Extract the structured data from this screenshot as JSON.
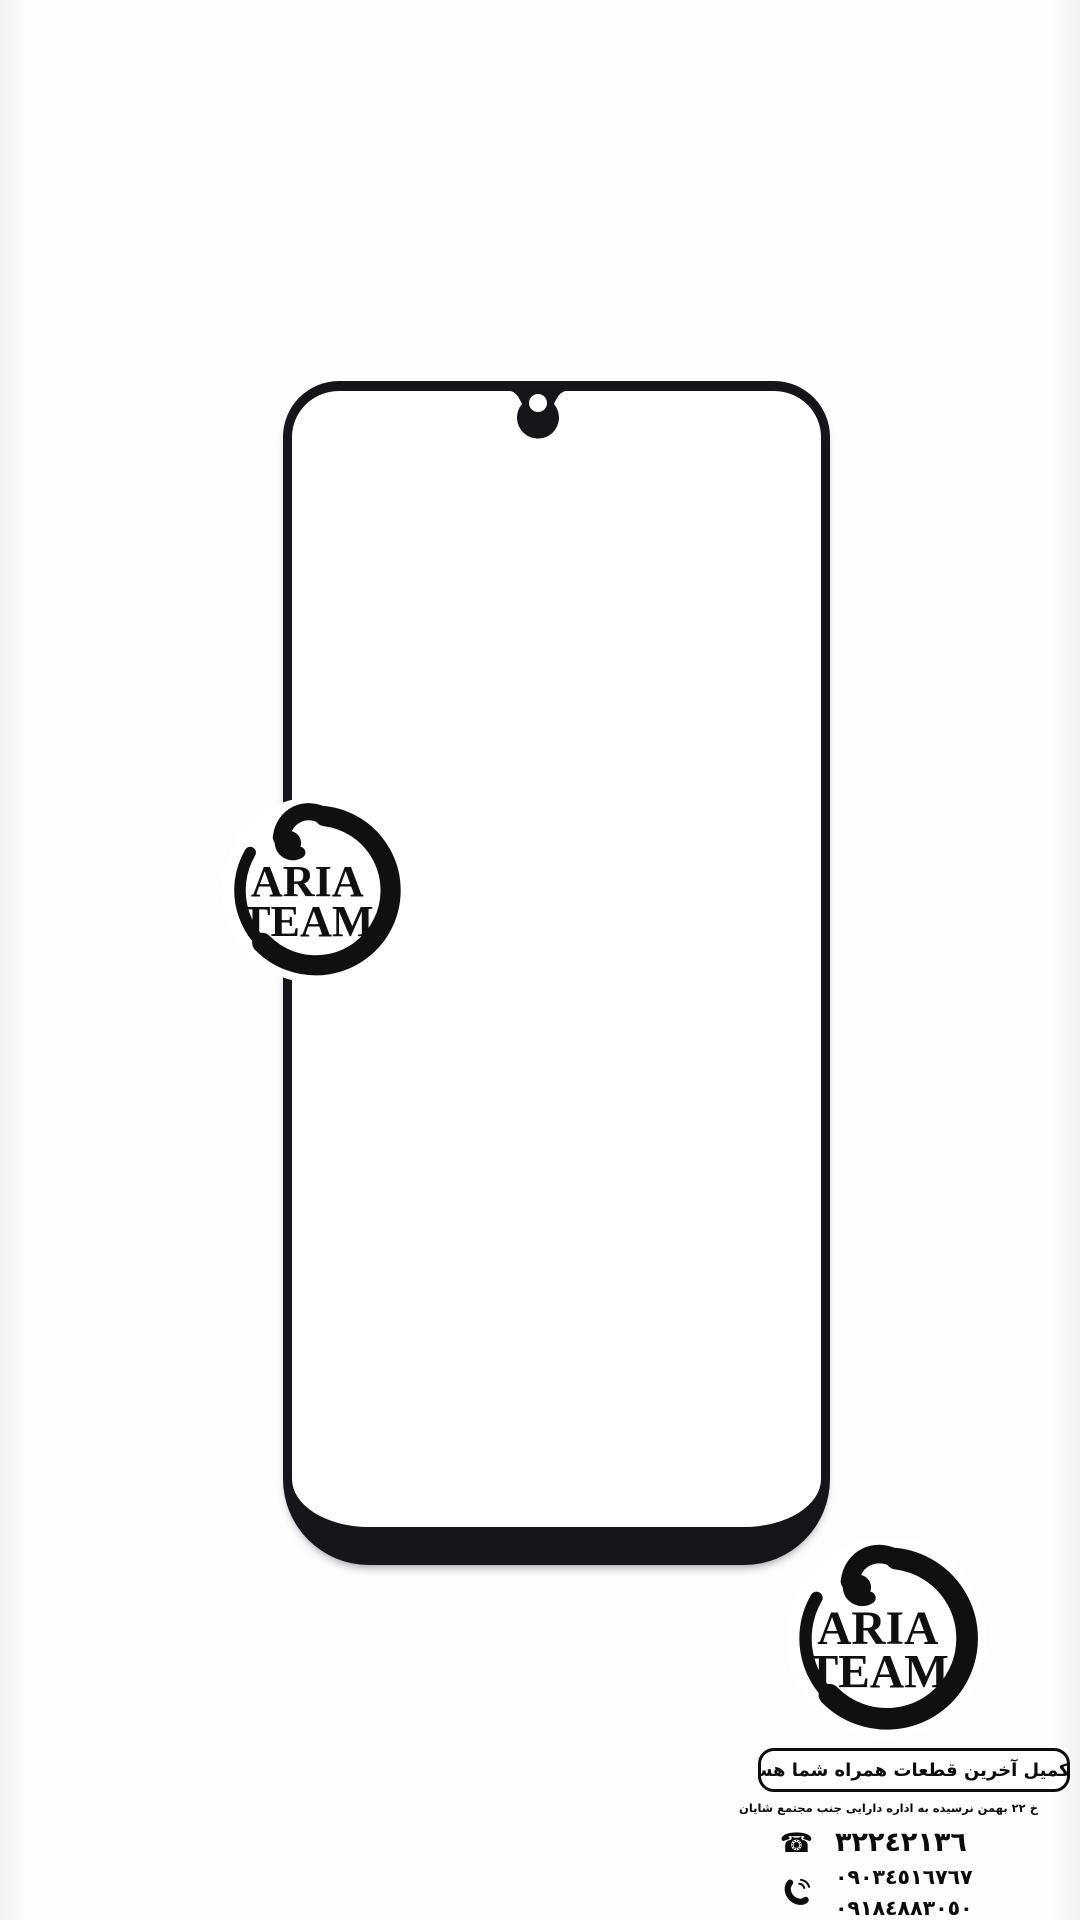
{
  "page": {
    "background_color": "#fdfdfd",
    "description": "product advertisement for a phone front glass replacement part"
  },
  "phone_glass": {
    "frame_color": "#15151a",
    "style": "waterdrop-notch front glass outline with thick bottom chin"
  },
  "logo": {
    "word1": "ARIA",
    "word2": "TEAM",
    "color": "#101010"
  },
  "icons": {
    "landline_glyph": "☎",
    "landline": "telephone-icon",
    "mobile": "phone-handset-icon",
    "address": "location-pin-icon"
  },
  "contact": {
    "tagline": "در تکمیل آخرین قطعات همراه شما هستیم",
    "address": "خ ۲۲ بهمن نرسیده به اداره دارایی جنب مجتمع شایان",
    "phone_landline": "٣٢٢٤٢١٣٦",
    "phone_mobile_1": "٠٩٠٣٤٥١٦٧٦٧",
    "phone_mobile_2": "٠٩١٨٤٨٨٣٠٥٠",
    "text_color": "#0c0c0c"
  }
}
